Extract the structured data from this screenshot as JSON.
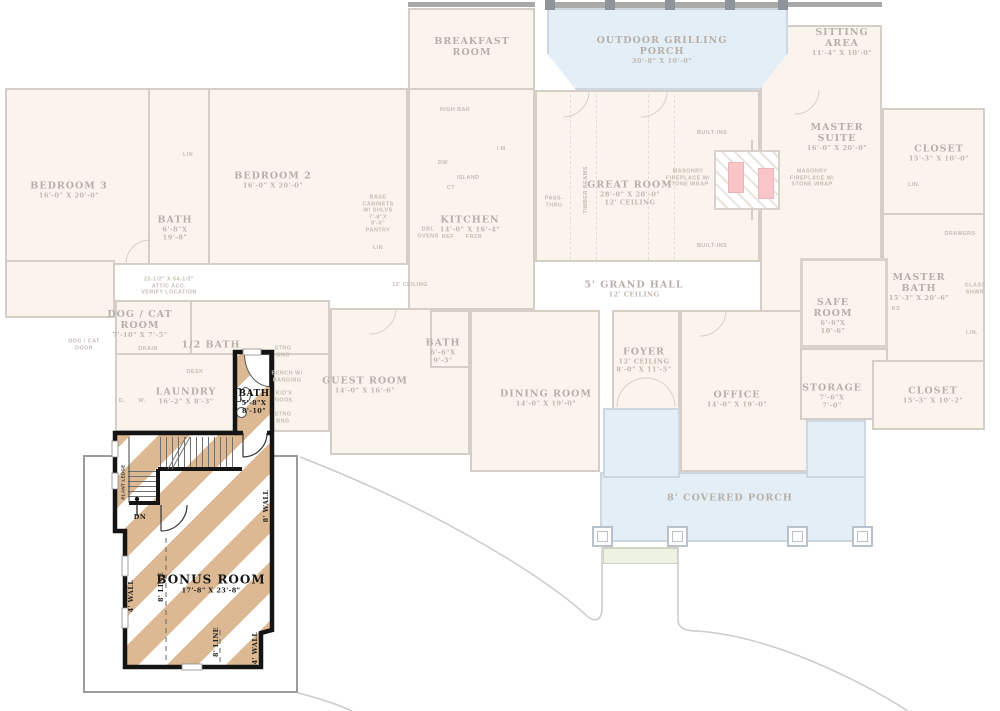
{
  "colors": {
    "highlight_stripe": "#dcb993",
    "highlight_wall": "#141414",
    "faded_wall": "#d4cec6",
    "faded_text": "#b7b0a8",
    "porch_blue": "#e4eef6",
    "room_cream": "#faf4ec",
    "fireplace_pink": "#f8c6c8",
    "lower_floor_outline": "#9e9c98"
  },
  "labels": {
    "rooms": [
      {
        "id": "breakfast-room",
        "x": 472,
        "y": 47,
        "lines": [
          {
            "t": "BREAKFAST",
            "c": "r"
          },
          {
            "t": "ROOM",
            "c": "r"
          }
        ]
      },
      {
        "id": "outdoor-grilling-porch",
        "x": 662,
        "y": 50,
        "lines": [
          {
            "t": "OUTDOOR GRILLING",
            "c": "r"
          },
          {
            "t": "PORCH",
            "c": "r"
          },
          {
            "t": "30'-8\" X 10'-0\"",
            "c": "d"
          }
        ]
      },
      {
        "id": "sitting-area",
        "x": 842,
        "y": 42,
        "lines": [
          {
            "t": "SITTING",
            "c": "r"
          },
          {
            "t": "AREA",
            "c": "r"
          },
          {
            "t": "11'-4\" X 10'-0\"",
            "c": "d"
          }
        ]
      },
      {
        "id": "bedroom-3",
        "x": 69,
        "y": 190,
        "lines": [
          {
            "t": "BEDROOM 3",
            "c": "r"
          },
          {
            "t": "16'-0\" X 20'-0\"",
            "c": "d"
          }
        ]
      },
      {
        "id": "bedrooms-bath",
        "x": 175,
        "y": 228,
        "lines": [
          {
            "t": "BATH",
            "c": "r"
          },
          {
            "t": "6'-8\"X",
            "c": "d"
          },
          {
            "t": "19'-8\"",
            "c": "d"
          }
        ]
      },
      {
        "id": "bedroom-2",
        "x": 273,
        "y": 180,
        "lines": [
          {
            "t": "BEDROOM 2",
            "c": "r"
          },
          {
            "t": "16'-0\" X 20'-0\"",
            "c": "d"
          }
        ]
      },
      {
        "id": "kitchen",
        "x": 470,
        "y": 224,
        "lines": [
          {
            "t": "KITCHEN",
            "c": "r"
          },
          {
            "t": "14'-0\" X 16'-4\"",
            "c": "d"
          }
        ]
      },
      {
        "id": "great-room",
        "x": 630,
        "y": 193,
        "lines": [
          {
            "t": "GREAT ROOM",
            "c": "r"
          },
          {
            "t": "28'-0\" X 20'-0\"",
            "c": "d"
          },
          {
            "t": "12' CEILING",
            "c": "d"
          }
        ]
      },
      {
        "id": "master-suite",
        "x": 837,
        "y": 137,
        "lines": [
          {
            "t": "MASTER",
            "c": "r"
          },
          {
            "t": "SUITE",
            "c": "r"
          },
          {
            "t": "16'-0\" X 20'-0\"",
            "c": "d"
          }
        ]
      },
      {
        "id": "closet-top-right",
        "x": 939,
        "y": 153,
        "lines": [
          {
            "t": "CLOSET",
            "c": "r"
          },
          {
            "t": "15'-3\" X 10'-0\"",
            "c": "d"
          }
        ]
      },
      {
        "id": "master-bath",
        "x": 919,
        "y": 287,
        "lines": [
          {
            "t": "MASTER",
            "c": "r"
          },
          {
            "t": "BATH",
            "c": "r"
          },
          {
            "t": "15'-3\" X 20'-6\"",
            "c": "d"
          }
        ]
      },
      {
        "id": "safe-room",
        "x": 833,
        "y": 316,
        "lines": [
          {
            "t": "SAFE",
            "c": "r"
          },
          {
            "t": "ROOM",
            "c": "r"
          },
          {
            "t": "6'-6\"X",
            "c": "d"
          },
          {
            "t": "10'-6\"",
            "c": "d"
          }
        ]
      },
      {
        "id": "grand-hall",
        "x": 634,
        "y": 289,
        "lines": [
          {
            "t": "5' GRAND HALL",
            "c": "r"
          },
          {
            "t": "12' CEILING",
            "c": "d"
          }
        ]
      },
      {
        "id": "foyer",
        "x": 644,
        "y": 360,
        "lines": [
          {
            "t": "FOYER",
            "c": "r"
          },
          {
            "t": "12' CEILING",
            "c": "d"
          },
          {
            "t": "8'-0\" X 11'-5\"",
            "c": "d"
          }
        ]
      },
      {
        "id": "dining-room",
        "x": 546,
        "y": 398,
        "lines": [
          {
            "t": "DINING ROOM",
            "c": "r"
          },
          {
            "t": "14'-0\" X 19'-0\"",
            "c": "d"
          }
        ]
      },
      {
        "id": "office",
        "x": 737,
        "y": 399,
        "lines": [
          {
            "t": "OFFICE",
            "c": "r"
          },
          {
            "t": "14'-0\" X 19'-0\"",
            "c": "d"
          }
        ]
      },
      {
        "id": "storage",
        "x": 832,
        "y": 396,
        "lines": [
          {
            "t": "STORAGE",
            "c": "r"
          },
          {
            "t": "7'-6\"X",
            "c": "d"
          },
          {
            "t": "7'-0\"",
            "c": "d"
          }
        ]
      },
      {
        "id": "closet-bottom-right",
        "x": 933,
        "y": 395,
        "lines": [
          {
            "t": "CLOSET",
            "c": "r"
          },
          {
            "t": "15'-3\" X 10'-2\"",
            "c": "d"
          }
        ]
      },
      {
        "id": "guest-room",
        "x": 365,
        "y": 385,
        "lines": [
          {
            "t": "GUEST ROOM",
            "c": "r"
          },
          {
            "t": "14'-0\" X 16'-6\"",
            "c": "d"
          }
        ]
      },
      {
        "id": "guest-bath",
        "x": 443,
        "y": 351,
        "lines": [
          {
            "t": "BATH",
            "c": "r"
          },
          {
            "t": "6'-6\"X",
            "c": "d"
          },
          {
            "t": "9'-3\"",
            "c": "d"
          }
        ]
      },
      {
        "id": "dog-cat-room",
        "x": 140,
        "y": 324,
        "lines": [
          {
            "t": "DOG / CAT",
            "c": "r"
          },
          {
            "t": "ROOM",
            "c": "r"
          },
          {
            "t": "7'-10\" X 7'-5\"",
            "c": "d"
          }
        ]
      },
      {
        "id": "half-bath",
        "x": 211,
        "y": 345,
        "lines": [
          {
            "t": "1/2 BATH",
            "c": "r"
          }
        ]
      },
      {
        "id": "laundry",
        "x": 186,
        "y": 396,
        "lines": [
          {
            "t": "LAUNDRY",
            "c": "r"
          },
          {
            "t": "16'-2\" X 8'-3\"",
            "c": "d"
          }
        ]
      },
      {
        "id": "covered-porch",
        "x": 730,
        "y": 498,
        "lines": [
          {
            "t": "8' COVERED PORCH",
            "c": "r"
          }
        ]
      }
    ],
    "annotations": [
      {
        "id": "high-bar",
        "x": 455,
        "y": 110,
        "lines": [
          {
            "t": "HIGH BAR",
            "c": "t"
          }
        ]
      },
      {
        "id": "dw",
        "x": 443,
        "y": 163,
        "lines": [
          {
            "t": "DW",
            "c": "t"
          }
        ]
      },
      {
        "id": "ice-maker",
        "x": 502,
        "y": 149,
        "lines": [
          {
            "t": "I.M.",
            "c": "t"
          }
        ]
      },
      {
        "id": "island",
        "x": 468,
        "y": 178,
        "lines": [
          {
            "t": "ISLAND",
            "c": "t"
          }
        ]
      },
      {
        "id": "ct",
        "x": 451,
        "y": 188,
        "lines": [
          {
            "t": "CT",
            "c": "t"
          }
        ]
      },
      {
        "id": "pantry",
        "x": 378,
        "y": 214,
        "lines": [
          {
            "t": "BASE",
            "c": "t"
          },
          {
            "t": "CABINETS",
            "c": "t"
          },
          {
            "t": "W/ SHLVS",
            "c": "t"
          },
          {
            "t": "7'-8\"X",
            "c": "t"
          },
          {
            "t": "8'-0\"",
            "c": "t"
          },
          {
            "t": "PANTRY",
            "c": "t"
          }
        ]
      },
      {
        "id": "dbl-ovens",
        "x": 428,
        "y": 233,
        "lines": [
          {
            "t": "DBL",
            "c": "t"
          },
          {
            "t": "OVENS",
            "c": "t"
          }
        ]
      },
      {
        "id": "ref",
        "x": 448,
        "y": 237,
        "lines": [
          {
            "t": "REF",
            "c": "t"
          }
        ]
      },
      {
        "id": "frzr",
        "x": 474,
        "y": 237,
        "lines": [
          {
            "t": "FRZR",
            "c": "t"
          }
        ]
      },
      {
        "id": "lin-kitchen",
        "x": 378,
        "y": 248,
        "lines": [
          {
            "t": "LIN",
            "c": "t"
          }
        ]
      },
      {
        "id": "ceiling-kitchen",
        "x": 410,
        "y": 285,
        "lines": [
          {
            "t": "12' CEILING",
            "c": "t"
          }
        ]
      },
      {
        "id": "pass-thru",
        "x": 554,
        "y": 202,
        "lines": [
          {
            "t": "PASS-",
            "c": "t"
          },
          {
            "t": "THRU",
            "c": "t"
          }
        ]
      },
      {
        "id": "timber-beams",
        "x": 586,
        "y": 190,
        "rot": true,
        "lines": [
          {
            "t": "TIMBER BEAMS",
            "c": "t"
          }
        ]
      },
      {
        "id": "built-ins-top",
        "x": 712,
        "y": 133,
        "lines": [
          {
            "t": "BUILT-INS",
            "c": "t"
          }
        ]
      },
      {
        "id": "built-ins-bottom",
        "x": 712,
        "y": 246,
        "lines": [
          {
            "t": "BUILT-INS",
            "c": "t"
          }
        ]
      },
      {
        "id": "masonry-left",
        "x": 688,
        "y": 178,
        "lines": [
          {
            "t": "MASONRY",
            "c": "t"
          },
          {
            "t": "FIREPLACE W/",
            "c": "t"
          },
          {
            "t": "STONE WRAP",
            "c": "t"
          }
        ]
      },
      {
        "id": "masonry-right",
        "x": 812,
        "y": 178,
        "lines": [
          {
            "t": "MASONRY",
            "c": "t"
          },
          {
            "t": "FIREPLACE W/",
            "c": "t"
          },
          {
            "t": "STONE WRAP",
            "c": "t"
          }
        ]
      },
      {
        "id": "lin-master-closet",
        "x": 914,
        "y": 185,
        "lines": [
          {
            "t": "LIN.",
            "c": "t"
          }
        ]
      },
      {
        "id": "drawers",
        "x": 960,
        "y": 234,
        "lines": [
          {
            "t": "DRAWERS",
            "c": "t"
          }
        ]
      },
      {
        "id": "glass-shwr",
        "x": 975,
        "y": 289,
        "lines": [
          {
            "t": "GLASS",
            "c": "t"
          },
          {
            "t": "SHWR",
            "c": "t"
          }
        ]
      },
      {
        "id": "ks",
        "x": 896,
        "y": 309,
        "lines": [
          {
            "t": "KS",
            "c": "t"
          }
        ]
      },
      {
        "id": "lin-master-bath",
        "x": 972,
        "y": 333,
        "lines": [
          {
            "t": "LIN.",
            "c": "t"
          }
        ]
      },
      {
        "id": "lin-bedroom-bath",
        "x": 188,
        "y": 155,
        "lines": [
          {
            "t": "LIN",
            "c": "t"
          }
        ]
      },
      {
        "id": "dog-cat-door",
        "x": 84,
        "y": 345,
        "lines": [
          {
            "t": "DOG / CAT",
            "c": "t"
          },
          {
            "t": "DOOR",
            "c": "t"
          }
        ]
      },
      {
        "id": "drain",
        "x": 148,
        "y": 349,
        "lines": [
          {
            "t": "DRAIN",
            "c": "t"
          }
        ]
      },
      {
        "id": "attic-access",
        "x": 169,
        "y": 286,
        "lines": [
          {
            "t": "22-1/2\" X 54-1/2\"",
            "c": "t"
          },
          {
            "t": "ATTIC ACC.",
            "c": "t"
          },
          {
            "t": "VERIFY LOCATION",
            "c": "t"
          }
        ]
      },
      {
        "id": "desk",
        "x": 195,
        "y": 372,
        "lines": [
          {
            "t": "DESK",
            "c": "t"
          }
        ]
      },
      {
        "id": "dryer",
        "x": 122,
        "y": 401,
        "lines": [
          {
            "t": "D.",
            "c": "t"
          }
        ]
      },
      {
        "id": "washer",
        "x": 142,
        "y": 401,
        "lines": [
          {
            "t": "W.",
            "c": "t"
          }
        ]
      },
      {
        "id": "strg-upper",
        "x": 283,
        "y": 352,
        "lines": [
          {
            "t": "STRG",
            "c": "t"
          },
          {
            "t": "BNG",
            "c": "t"
          }
        ]
      },
      {
        "id": "bench-hanging",
        "x": 287,
        "y": 377,
        "lines": [
          {
            "t": "BENCH W/",
            "c": "t"
          },
          {
            "t": "HANGING",
            "c": "t"
          }
        ]
      },
      {
        "id": "kids-nook",
        "x": 284,
        "y": 397,
        "lines": [
          {
            "t": "KID'S",
            "c": "t"
          },
          {
            "t": "NOOK",
            "c": "t"
          }
        ]
      },
      {
        "id": "strg-lower",
        "x": 283,
        "y": 418,
        "lines": [
          {
            "t": "STRG",
            "c": "t"
          },
          {
            "t": "BNG",
            "c": "t"
          }
        ]
      }
    ],
    "highlight": [
      {
        "id": "bonus-room",
        "x": 211,
        "y": 584,
        "lines": [
          {
            "t": "BONUS ROOM",
            "c": "B"
          },
          {
            "t": "17'-8\" X 23'-8\"",
            "c": "b"
          }
        ]
      },
      {
        "id": "bonus-bath",
        "x": 254,
        "y": 402,
        "lines": [
          {
            "t": "BATH",
            "c": "k"
          },
          {
            "t": "5'-8\"X",
            "c": "b"
          },
          {
            "t": "8'-10\"",
            "c": "b"
          }
        ]
      },
      {
        "id": "stairs-dn",
        "x": 140,
        "y": 517,
        "lines": [
          {
            "t": "DN",
            "c": "b"
          }
        ]
      },
      {
        "id": "plant-ledge",
        "x": 123,
        "y": 482,
        "rot": true,
        "lines": [
          {
            "t": "PLANT LEDGE",
            "c": "p"
          }
        ]
      },
      {
        "id": "wall-4ft-left",
        "x": 131,
        "y": 596,
        "rot": true,
        "lines": [
          {
            "t": "4' WALL",
            "c": "b"
          }
        ]
      },
      {
        "id": "line-8ft-center",
        "x": 161,
        "y": 587,
        "rot": true,
        "lines": [
          {
            "t": "8' LINE",
            "c": "b"
          }
        ]
      },
      {
        "id": "wall-8ft-right",
        "x": 266,
        "y": 506,
        "rot": true,
        "lines": [
          {
            "t": "8' WALL",
            "c": "b"
          }
        ]
      },
      {
        "id": "line-8ft-bottom",
        "x": 216,
        "y": 642,
        "rot": true,
        "lines": [
          {
            "t": "8' LINE",
            "c": "b"
          }
        ]
      },
      {
        "id": "wall-4ft-bottom",
        "x": 255,
        "y": 648,
        "rot": true,
        "lines": [
          {
            "t": "4' WALL",
            "c": "b"
          }
        ]
      }
    ]
  }
}
